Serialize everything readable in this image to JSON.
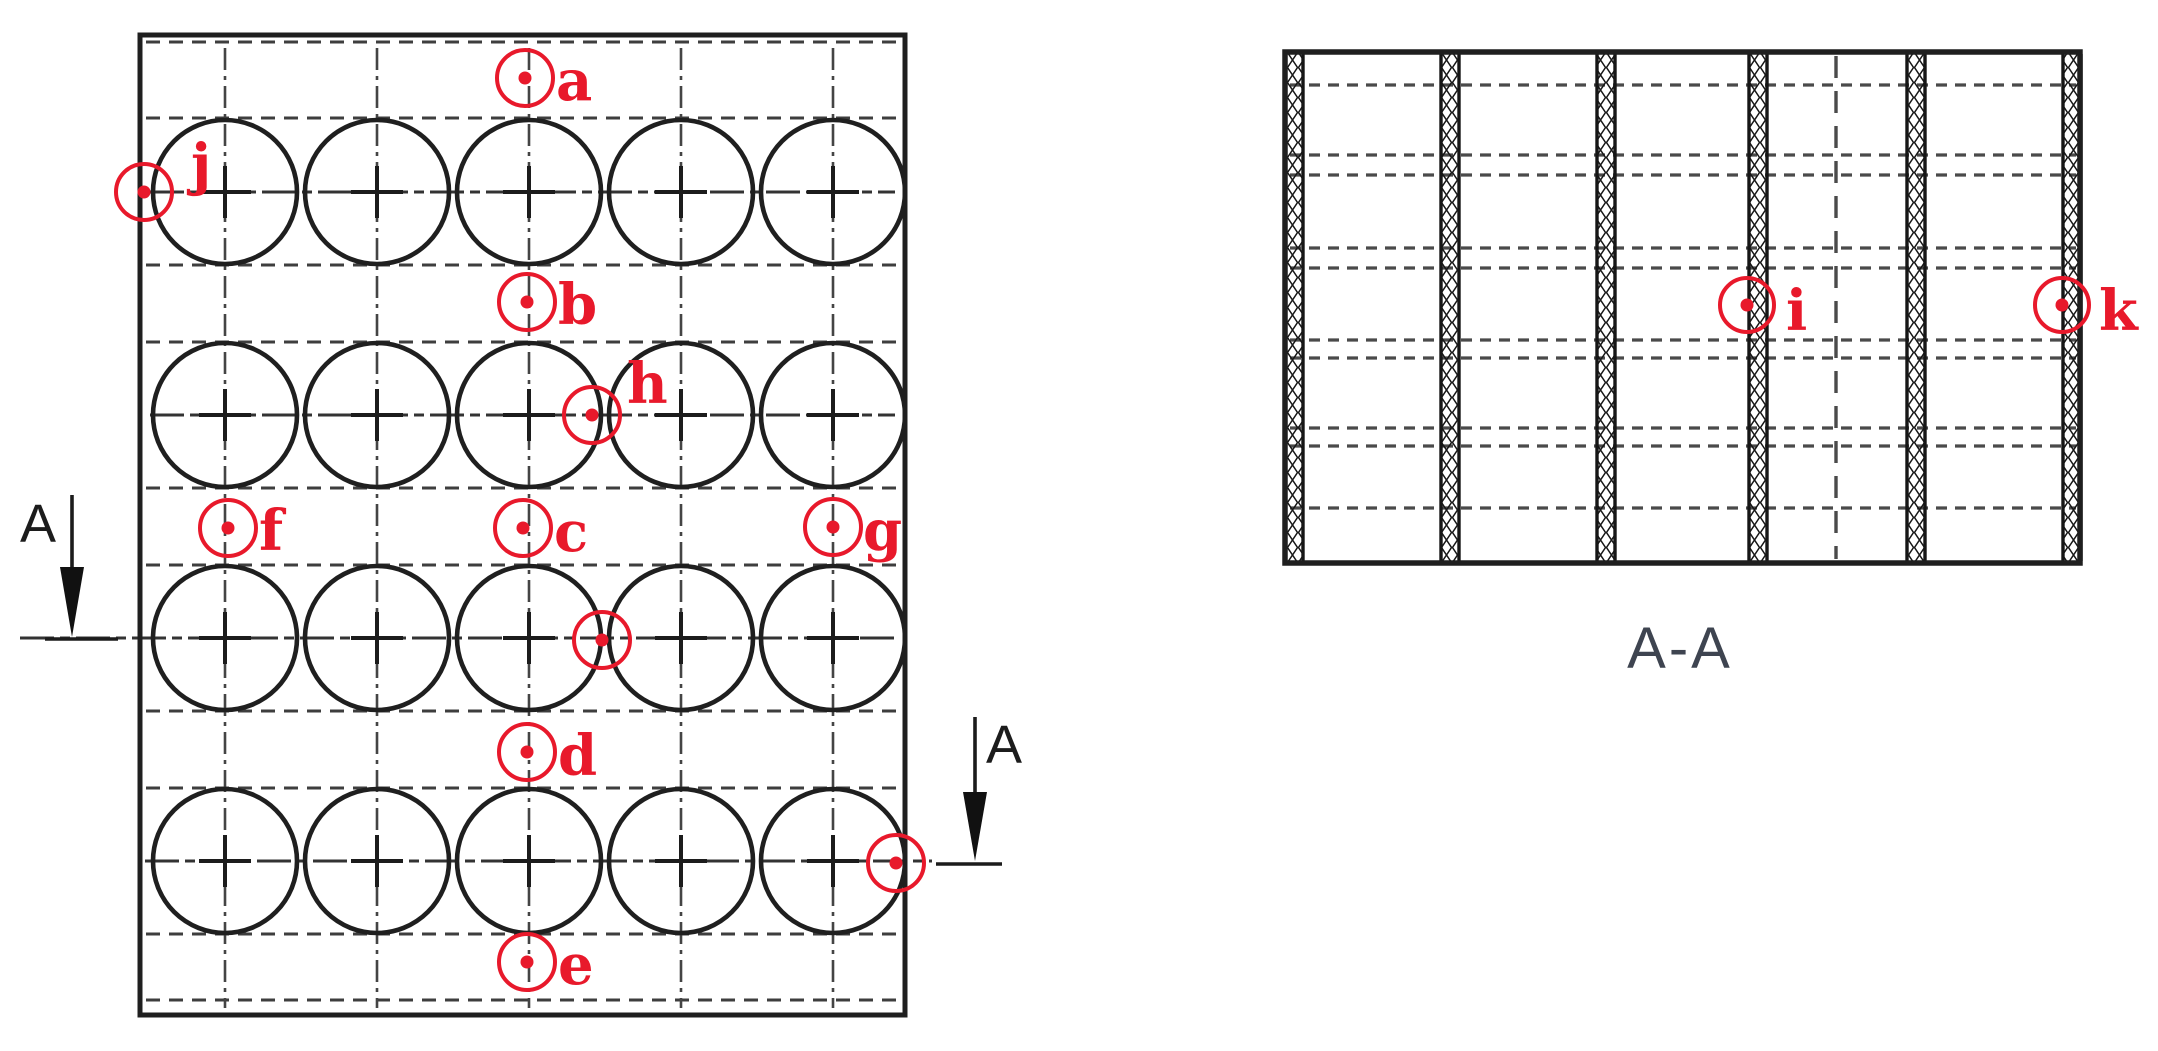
{
  "plan_view": {
    "grid": {
      "rows": 4,
      "columns": 5
    },
    "markers": [
      {
        "id": "a",
        "label": "a"
      },
      {
        "id": "b",
        "label": "b"
      },
      {
        "id": "c",
        "label": "c"
      },
      {
        "id": "d",
        "label": "d"
      },
      {
        "id": "e",
        "label": "e"
      },
      {
        "id": "f",
        "label": "f"
      },
      {
        "id": "g",
        "label": "g"
      },
      {
        "id": "h",
        "label": "h"
      },
      {
        "id": "j",
        "label": "j"
      }
    ],
    "unlabeled_marker_count": 2,
    "section_arrows": [
      {
        "label": "A"
      },
      {
        "label": "A"
      }
    ]
  },
  "section_view": {
    "title": "A-A",
    "markers": [
      {
        "id": "i",
        "label": "i"
      },
      {
        "id": "k",
        "label": "k"
      }
    ]
  },
  "colors": {
    "line": "#1f1f1f",
    "dashed": "#3e3e3e",
    "marker": "#e8192b",
    "section_title": "#3e4450",
    "arrow_label": "#1c1c1c"
  }
}
